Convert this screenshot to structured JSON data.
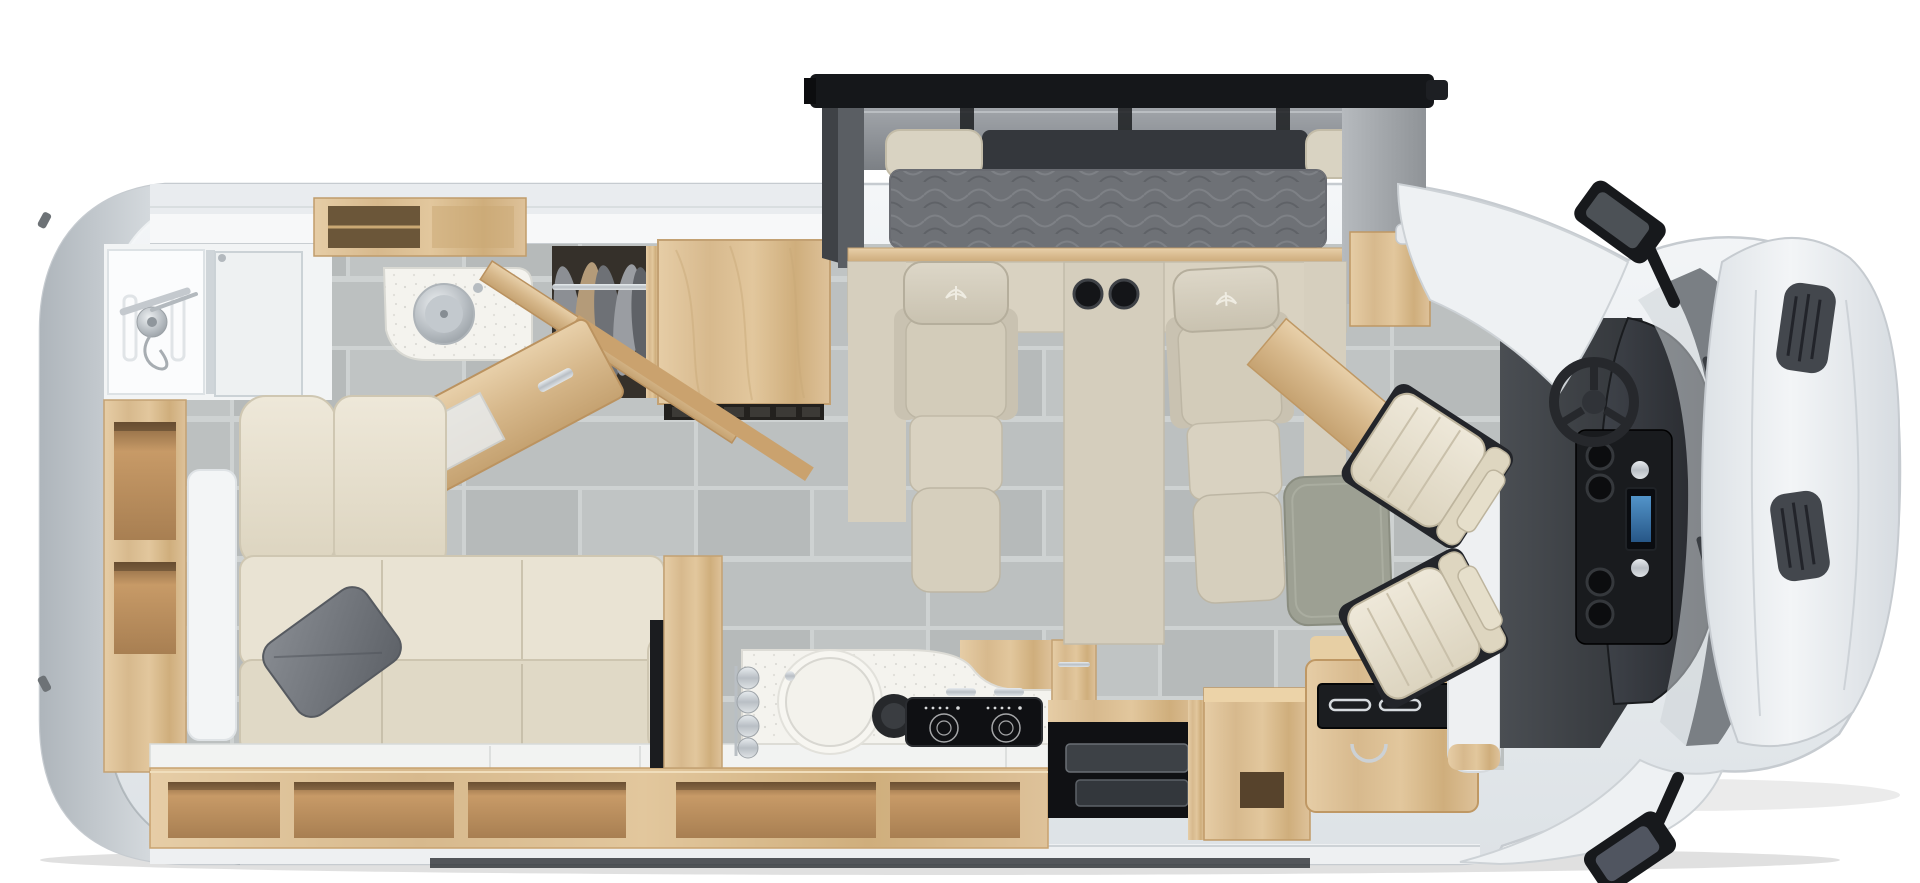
{
  "meta": {
    "description": "Top-down 3D rendered floor plan of a Class B+ motorhome (RV) with rear bathroom, wardrobe, murphy-bed slide-out with two recliners, L-shaped sofa, galley kitchen, entry step and drivers cab",
    "no_visible_text": true,
    "view": "overhead"
  },
  "palette": {
    "bg": "#ffffff",
    "bodyShell": "#eef1f3",
    "bodyEdge": "#c6cbd0",
    "wallBand": "#e9ecef",
    "wallInner": "#f7f8f9",
    "tile": "#bcc0c0",
    "tileAlt": "#b6baba",
    "grout": "#ced2d2",
    "woodLight": "#e2c79f",
    "woodMid": "#d6b88c",
    "woodDark": "#b08657",
    "creamSofa": "#e9e3d3",
    "creamSofaShade": "#ded6c2",
    "beigeChair": "#d6cfbe",
    "beigeConsole": "#d5cebd",
    "pillowGray": "#767a80",
    "mattress": "#6e7176",
    "slideFrame": "#15171a",
    "slideRoof": "#8d9196",
    "counterWhite": "#f4f3ee",
    "cooktopBlack": "#0f1013",
    "stepwellBlack": "#101114",
    "tableGray": "#9da093",
    "cabMat": "#3a3d42",
    "dashDark": "#34373c",
    "consoleBlack": "#191b1e",
    "screenBlue": "#4e9ad8",
    "cowlGray": "#7a7f84",
    "hoodSilver": "#e7ebee",
    "ventDark": "#43474d",
    "chrome": "#c8cdd2",
    "mirrorBlack": "#17191c",
    "glass": "#e9edef",
    "ledgeWhite": "#f2f3f2"
  },
  "regions": {
    "vehicle": {
      "label": "RV top view floor plan"
    },
    "rear_cap": {
      "label": "Rear exterior cap"
    },
    "bathroom": {
      "label": "Rear bathroom with shower and glass door"
    },
    "vanity": {
      "label": "Bathroom vanity with round stainless sink"
    },
    "bath_door": {
      "label": "Open bathroom door"
    },
    "wardrobe": {
      "label": "Wardrobe with hanging clothes"
    },
    "refrigerator": {
      "label": "Refrigerator cabinet"
    },
    "side_shelf": {
      "label": "Street-side open shelving"
    },
    "sofa": {
      "label": "L-shaped cream leather sofa with gray accent pillow"
    },
    "window_ledge": {
      "label": "Window ledge behind sofa"
    },
    "storage_cubbies": {
      "label": "Under-window open storage cubbies"
    },
    "kitchen": {
      "label": "Galley kitchen with round sink and two-burner cooktop"
    },
    "stepwell": {
      "label": "Entry door step well"
    },
    "entry_cabinet": {
      "label": "Entry-side cabinet"
    },
    "fridge_counter": {
      "label": "Counter unit with glass top beside entry"
    },
    "slideout": {
      "label": "Slide-out with stowed murphy bed mattress"
    },
    "recliner_left": {
      "label": "Left theater recliner"
    },
    "recliner_right": {
      "label": "Right theater recliner"
    },
    "cup_console": {
      "label": "Center console with cup holders"
    },
    "table": {
      "label": "Removable pedestal table"
    },
    "pillar": {
      "label": "Partition pillar at entry"
    },
    "cab": {
      "label": "Drivers cab with swiveled captain chairs"
    },
    "driver_seat": {
      "label": "Driver captain chair (swiveled)"
    },
    "passenger_seat": {
      "label": "Passenger captain chair (swiveled)"
    },
    "steering": {
      "label": "Steering wheel"
    },
    "dashboard": {
      "label": "Dashboard"
    },
    "center_console": {
      "label": "Cab center console with cup holders and screen"
    },
    "windshield": {
      "label": "Windshield and cowl with wipers"
    },
    "hood": {
      "label": "Hood with engine vents"
    },
    "mirror_top": {
      "label": "Driver side mirror"
    },
    "mirror_bottom": {
      "label": "Passenger side mirror"
    }
  }
}
